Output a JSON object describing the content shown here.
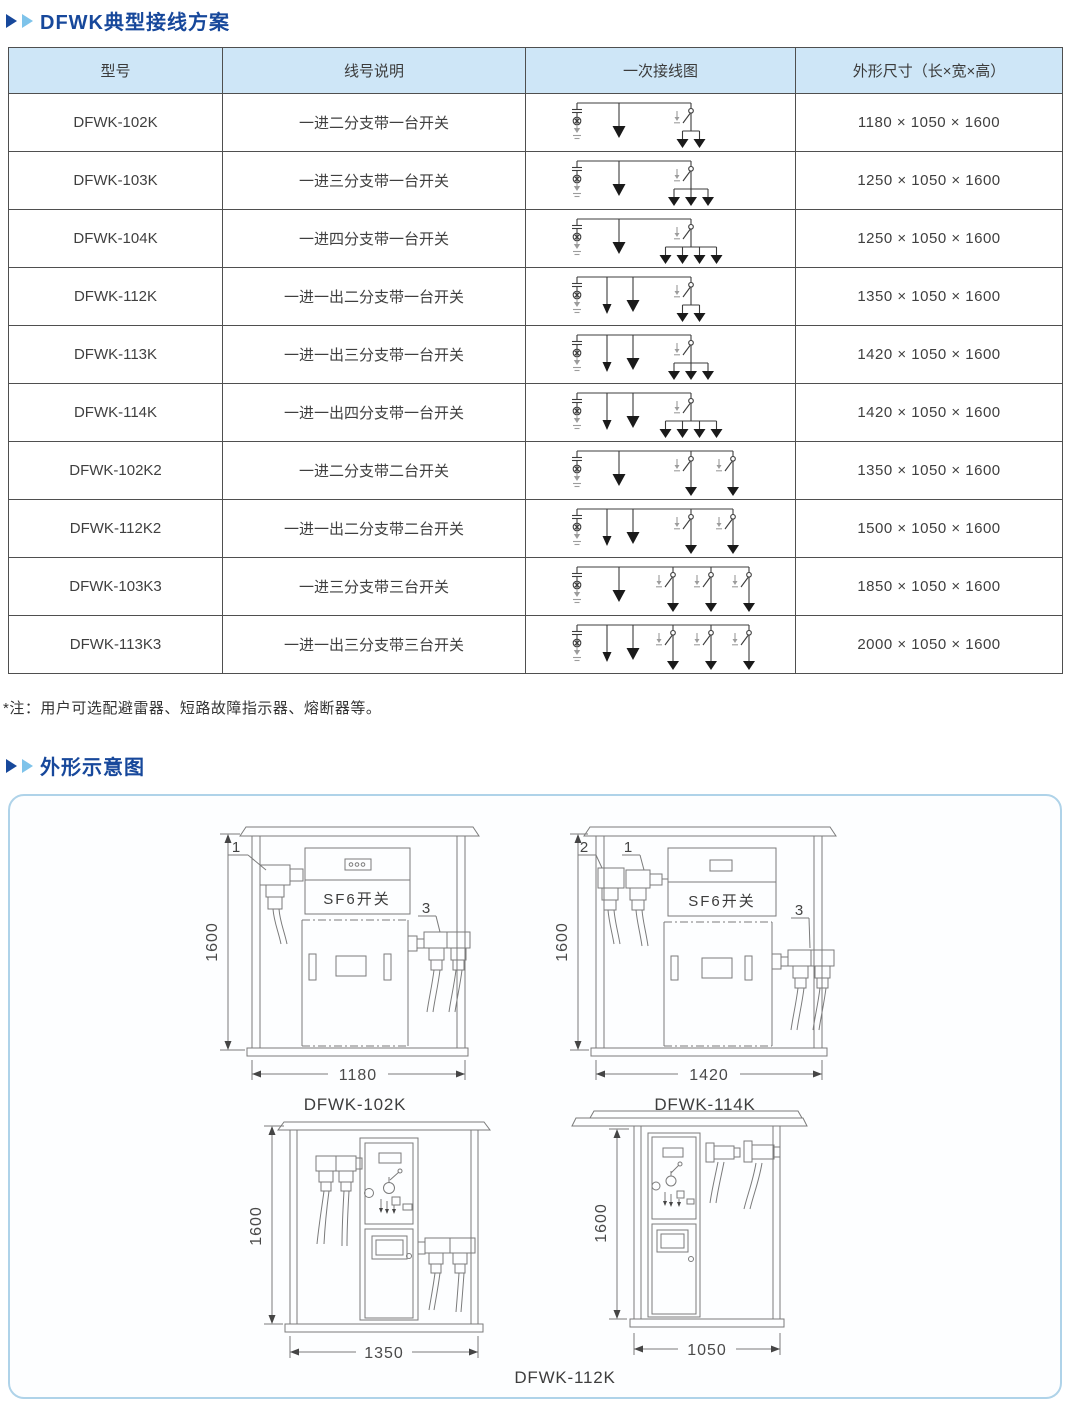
{
  "colors": {
    "accent": "#17489B",
    "accent_light": "#7EC3EA",
    "header_bg": "#CEE6F7",
    "panel_border": "#AFD3E9"
  },
  "section1": {
    "title": "DFWK典型接线方案"
  },
  "table": {
    "headers": [
      "型号",
      "线号说明",
      "一次接线图",
      "外形尺寸（长×宽×高）"
    ],
    "rows": [
      {
        "model": "DFWK-102K",
        "desc": "一进二分支带一台开关",
        "dims": "1180 × 1050 × 1600",
        "diagram": {
          "out": 0,
          "switches": 1,
          "outputs": 2
        }
      },
      {
        "model": "DFWK-103K",
        "desc": "一进三分支带一台开关",
        "dims": "1250 × 1050 × 1600",
        "diagram": {
          "out": 0,
          "switches": 1,
          "outputs": 3
        }
      },
      {
        "model": "DFWK-104K",
        "desc": "一进四分支带一台开关",
        "dims": "1250 × 1050 × 1600",
        "diagram": {
          "out": 0,
          "switches": 1,
          "outputs": 4
        }
      },
      {
        "model": "DFWK-112K",
        "desc": "一进一出二分支带一台开关",
        "dims": "1350 × 1050 × 1600",
        "diagram": {
          "out": 1,
          "switches": 1,
          "outputs": 2
        }
      },
      {
        "model": "DFWK-113K",
        "desc": "一进一出三分支带一台开关",
        "dims": "1420 × 1050 × 1600",
        "diagram": {
          "out": 1,
          "switches": 1,
          "outputs": 3
        }
      },
      {
        "model": "DFWK-114K",
        "desc": "一进一出四分支带一台开关",
        "dims": "1420 × 1050 × 1600",
        "diagram": {
          "out": 1,
          "switches": 1,
          "outputs": 4
        }
      },
      {
        "model": "DFWK-102K2",
        "desc": "一进二分支带二台开关",
        "dims": "1350 × 1050 × 1600",
        "diagram": {
          "out": 0,
          "switches": 2,
          "outputs": 1
        }
      },
      {
        "model": "DFWK-112K2",
        "desc": "一进一出二分支带二台开关",
        "dims": "1500 × 1050 × 1600",
        "diagram": {
          "out": 1,
          "switches": 2,
          "outputs": 1
        }
      },
      {
        "model": "DFWK-103K3",
        "desc": "一进三分支带三台开关",
        "dims": "1850 × 1050 × 1600",
        "diagram": {
          "out": 0,
          "switches": 3,
          "outputs": 1
        }
      },
      {
        "model": "DFWK-113K3",
        "desc": "一进一出三分支带三台开关",
        "dims": "2000 × 1050 × 1600",
        "diagram": {
          "out": 1,
          "switches": 3,
          "outputs": 1
        }
      }
    ]
  },
  "note": "*注：用户可选配避雷器、短路故障指示器、熔断器等。",
  "section2": {
    "title": "外形示意图"
  },
  "drawings": {
    "sf6_label": "SF6开关",
    "height_label": "1600",
    "a": {
      "caption": "DFWK-102K",
      "width_label": "1180",
      "callouts": [
        "1",
        "3"
      ]
    },
    "b": {
      "caption": "DFWK-114K",
      "width_label": "1420",
      "callouts": [
        "2",
        "1",
        "3"
      ]
    },
    "c": {
      "width_label": "1350"
    },
    "d": {
      "width_label": "1050"
    },
    "cd_caption": "DFWK-112K"
  }
}
